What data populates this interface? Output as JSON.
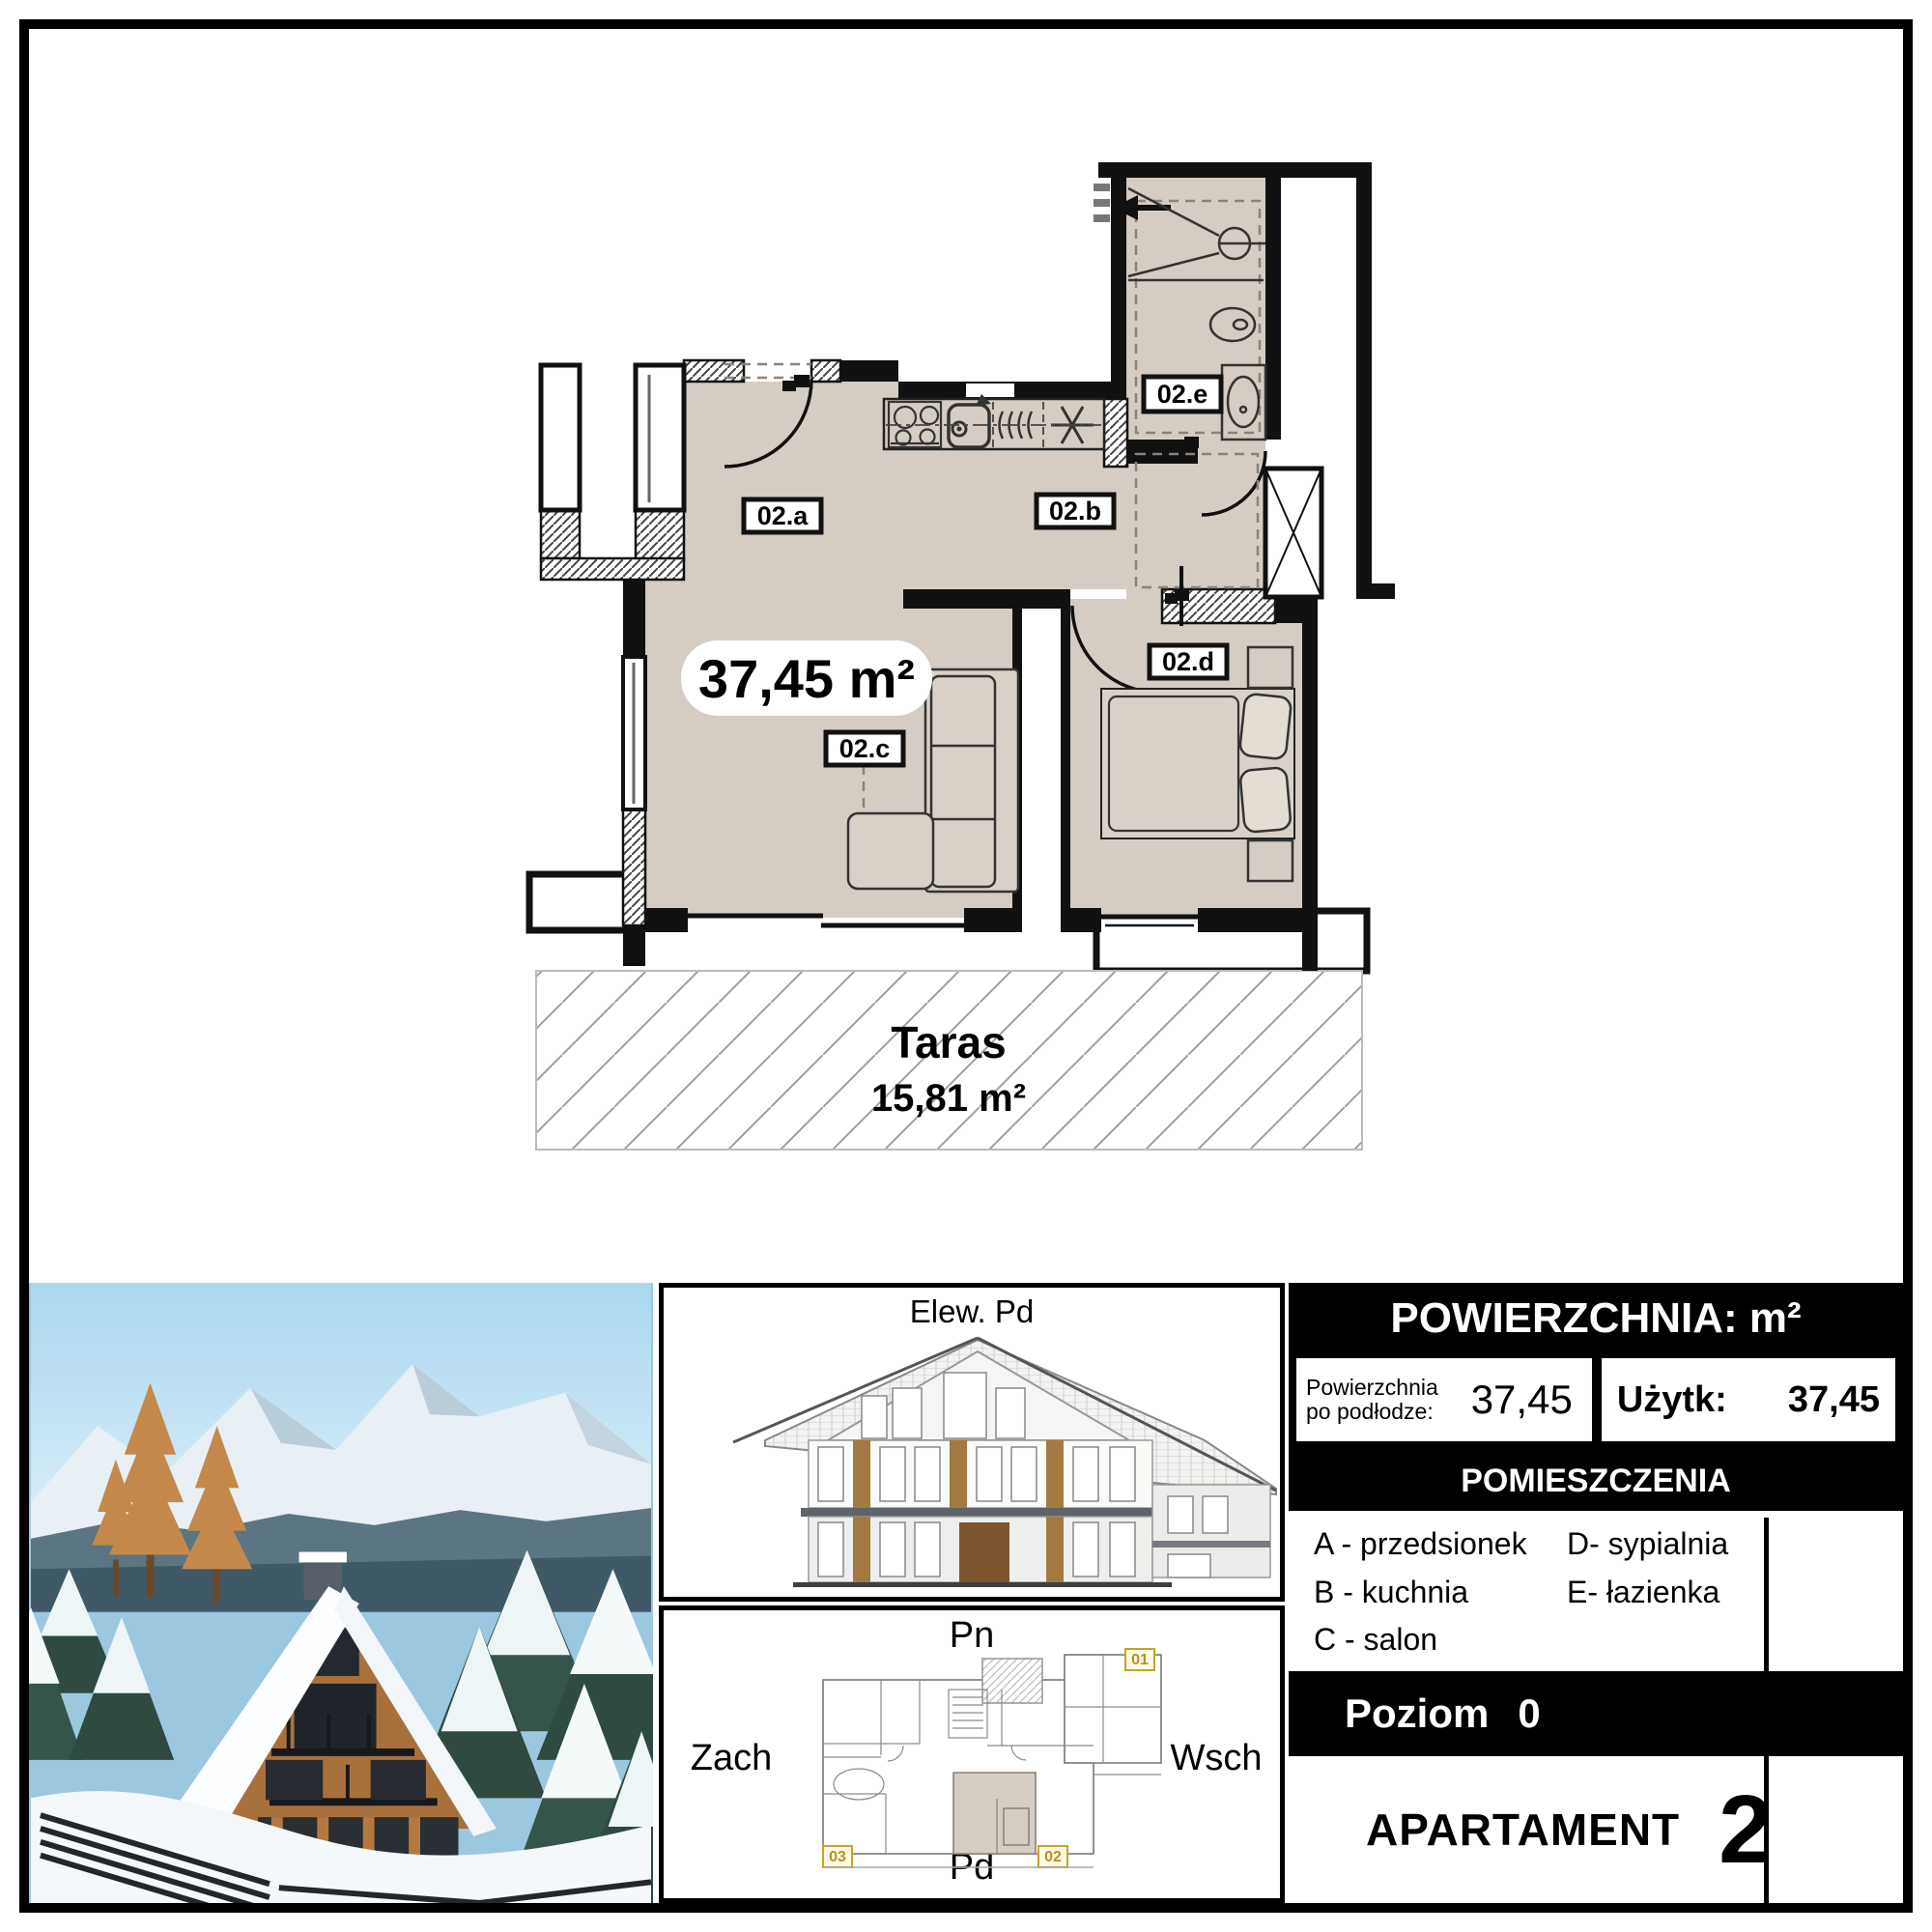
{
  "floor_plan": {
    "area_text": "37,45 m²",
    "rooms": {
      "a": "02.a",
      "b": "02.b",
      "c": "02.c",
      "d": "02.d",
      "e": "02.e"
    },
    "terrace_name": "Taras",
    "terrace_area": "15,81 m²"
  },
  "elevation": {
    "title": "Elew. Pd"
  },
  "site_plan": {
    "north": "Pn",
    "south": "Pd",
    "west": "Zach",
    "east": "Wsch",
    "unit_markers": [
      "01",
      "02",
      "03"
    ]
  },
  "info_panel": {
    "header": "POWIERZCHNIA: m²",
    "floor_label_line1": "Powierzchnia",
    "floor_label_line2": "po podłodze:",
    "floor_value": "37,45",
    "usable_label": "Użytk:",
    "usable_value": "37,45",
    "rooms_header": "POMIESZCZENIA",
    "legend": {
      "a": "A - przedsionek",
      "b": "B - kuchnia",
      "c": "C - salon",
      "d": "D- sypialnia",
      "e": "E- łazienka"
    },
    "level_label": "Poziom",
    "level_value": "0",
    "apartment_label": "APARTAMENT",
    "apartment_number": "2"
  },
  "colors": {
    "floor_beige": "#d5ccc3",
    "marker_yellow": "#c9a227",
    "wall_black": "#111111"
  }
}
